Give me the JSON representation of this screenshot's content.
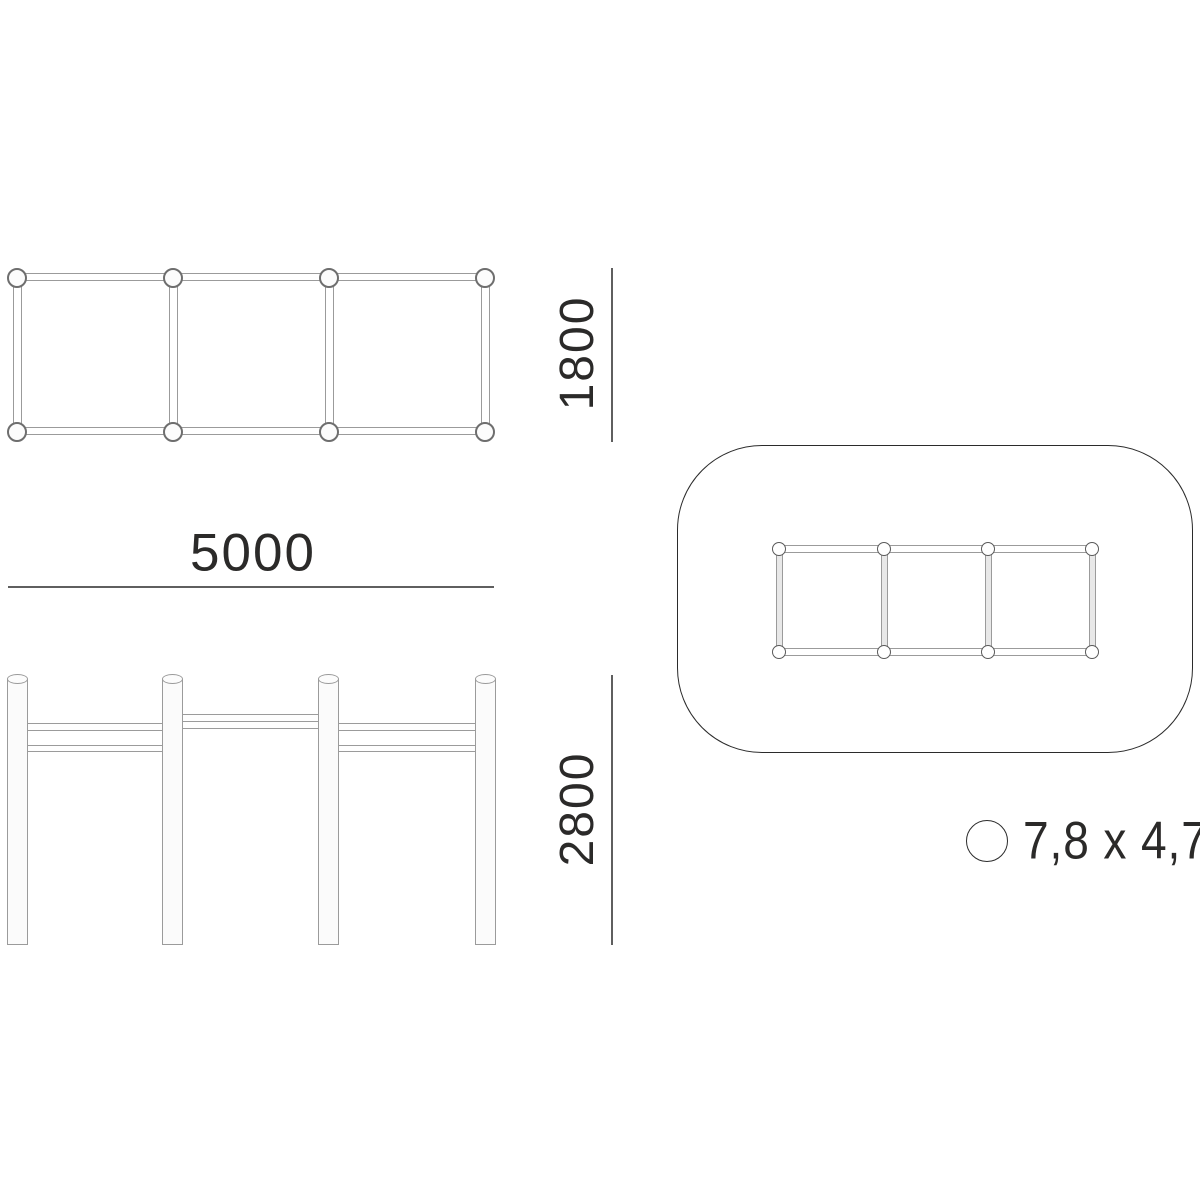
{
  "drawing": {
    "type": "equipment-dimension-drawing",
    "views": {
      "plan": {
        "modules": 3,
        "post_markers": 8
      },
      "elevation": {
        "posts": 4,
        "rail_sections": 3
      },
      "safety_zone": {
        "post_markers": 8,
        "modules": 3
      }
    },
    "labels": {
      "plan_depth": "1800",
      "plan_width": "5000",
      "elevation_height": "2800",
      "safety_zone_size": "7,8 x 4,7"
    },
    "icons": {
      "scale_marker": "circle-icon"
    },
    "colors": {
      "outline_gray": "#9b9b9b",
      "marker_gray": "#6e6e6e",
      "dimension_line": "#5f5f5f",
      "dark_stroke": "#2b2b2b",
      "text": "#2b2a29",
      "background": "#ffffff"
    }
  }
}
